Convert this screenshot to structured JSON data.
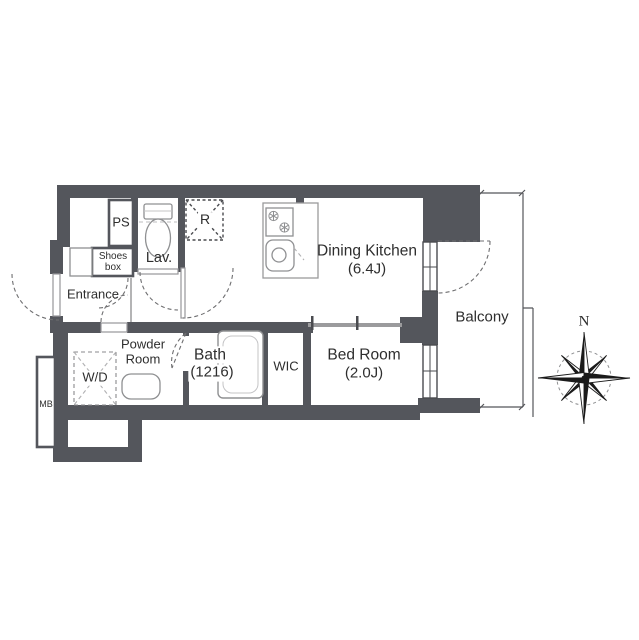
{
  "floorplan": {
    "rooms": {
      "ps": {
        "label": "PS"
      },
      "shoes_box": {
        "label_line1": "Shoes",
        "label_line2": "box"
      },
      "lavatory": {
        "label": "Lav."
      },
      "refrigerator": {
        "label": "R"
      },
      "dining_kitchen": {
        "name": "Dining Kitchen",
        "size": "(6.4J)"
      },
      "entrance": {
        "label": "Entrance"
      },
      "powder_room": {
        "label_line1": "Powder",
        "label_line2": "Room"
      },
      "washer_dryer": {
        "label": "W/D"
      },
      "meter_box": {
        "label": "MB"
      },
      "bath": {
        "name": "Bath",
        "size": "(1216)"
      },
      "wic": {
        "label": "WIC"
      },
      "bedroom": {
        "name": "Bed Room",
        "size": "(2.0J)"
      },
      "balcony": {
        "label": "Balcony"
      }
    },
    "compass": {
      "north_label": "N"
    },
    "colors": {
      "wall": "#54565c",
      "text": "#2e2e2e",
      "fixture": "#8f9092",
      "dashline": "#6e6e70"
    }
  }
}
